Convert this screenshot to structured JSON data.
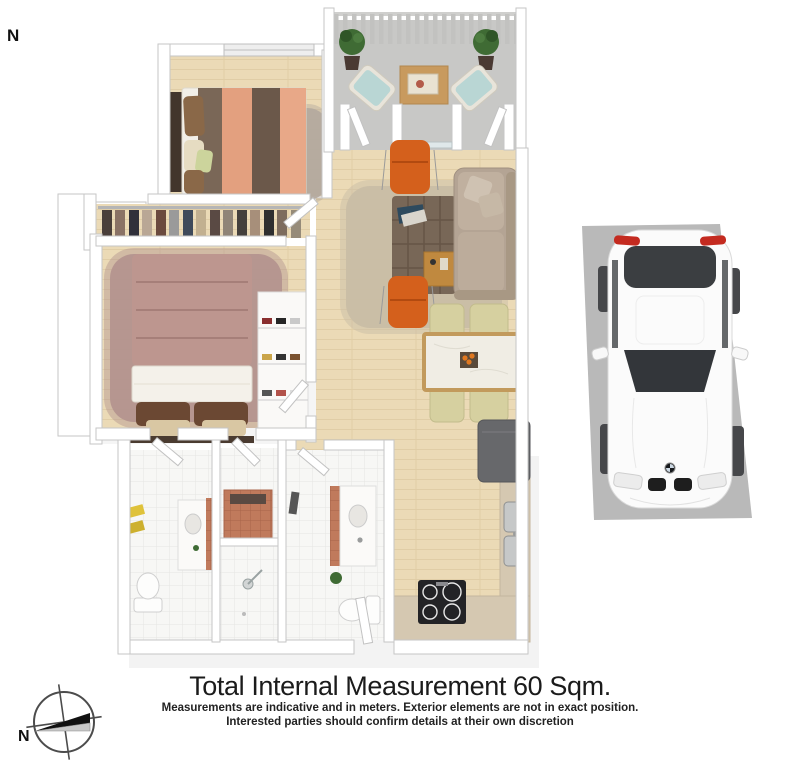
{
  "north_top": {
    "label": "N"
  },
  "compass": {
    "north_label": "N"
  },
  "title_block": {
    "title": "Total Internal Measurement 60 Sqm.",
    "disclaimer_line1": "Measurements are indicative and in meters. Exterior elements are not in exact position.",
    "disclaimer_line2": "Interested parties should confirm details at their own discretion"
  },
  "colors": {
    "wood": "#ebdab6",
    "wood-line": "#dfcba4",
    "balcony-floor": "#c8c8c6",
    "wall-stroke": "#c6c6c6",
    "rug-gray": "#b3a99d",
    "rug-mauve": "#b2928e",
    "rug-living": "#c9bda5",
    "accent-orange": "#d4601c",
    "sofa": "#b4a494",
    "ottoman": "#786757",
    "duvet-mauve": "#bd968f",
    "stripe-brown": "#6e5a4b",
    "stripe-salmon": "#e3a07f",
    "dining-chair": "#d6d0a0",
    "marble": "#f0ede4",
    "counter": "#d5c8b1",
    "fridge": "#67686b",
    "cooktop": "#232326",
    "terracotta": "#c07a5c",
    "towel-yellow": "#dfc23a",
    "plant-green": "#3f6b34",
    "car-pad": "#b9b9b9",
    "glass-dark": "#3a3d40",
    "tail-red": "#c42b20",
    "text": "#1b1b1b"
  }
}
